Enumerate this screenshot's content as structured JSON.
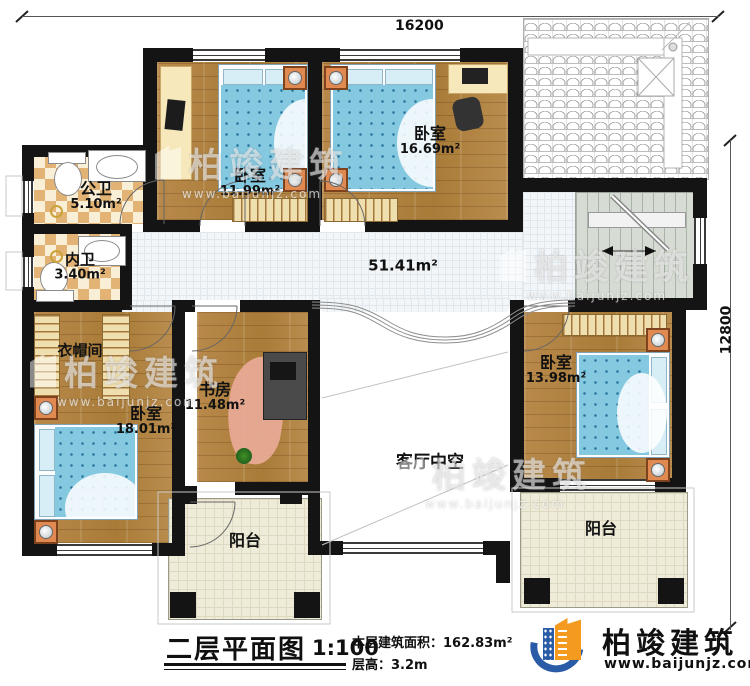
{
  "dimensions": {
    "top": "16200",
    "right": "12800"
  },
  "rooms": {
    "public_bath": {
      "name": "公卫",
      "area": "5.10m²"
    },
    "inner_bath": {
      "name": "内卫",
      "area": "3.40m²"
    },
    "bedroom_top_left": {
      "name": "卧室",
      "area": "11.99m²"
    },
    "bedroom_top": {
      "name": "卧室",
      "area": "16.69m²"
    },
    "hall": {
      "area": "51.41m²"
    },
    "cloakroom": {
      "name": "衣帽间"
    },
    "bedroom_left": {
      "name": "卧室",
      "area": "18.01m²"
    },
    "study": {
      "name": "书房",
      "area": "11.48m²"
    },
    "bedroom_right": {
      "name": "卧室",
      "area": "13.98m²"
    },
    "living_void": {
      "name": "客厅中空"
    },
    "balcony_left": {
      "name": "阳台"
    },
    "balcony_right": {
      "name": "阳台"
    }
  },
  "footer": {
    "title": "二层平面图",
    "scale": "1:100",
    "area_label": "本层建筑面积：",
    "area_value": "162.83m²",
    "height_label": "层高：",
    "height_value": "3.2m"
  },
  "brand": {
    "name": "柏竣建筑",
    "url": "www.baijunjz.com"
  },
  "watermark": {
    "name": "柏竣建筑",
    "url": "www.baijunjz.com"
  },
  "colors": {
    "wall": "#141414",
    "wood": "#b1813e",
    "bed_blue": "#85c9e1",
    "tile_tan": "#e2b375",
    "balcony_cream": "#eeebd8",
    "stair_grey": "#d6dcd4",
    "nightstand_orange": "#e08a52",
    "brand_blue": "#2a5ba6",
    "brand_orange": "#f49a1f"
  }
}
